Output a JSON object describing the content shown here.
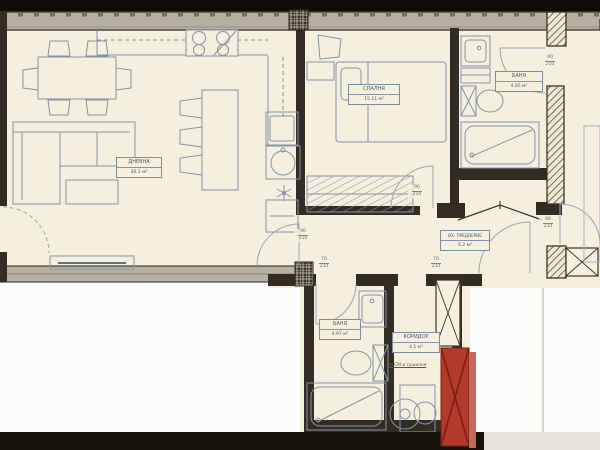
{
  "meta": {
    "type": "architectural-floor-plan",
    "language": "bg"
  },
  "rooms": [
    {
      "id": "living",
      "name": "ДНЕВНА",
      "area": "30.1 м²"
    },
    {
      "id": "bedroom",
      "name": "СПАЛНЯ",
      "area": "15.11 м²"
    },
    {
      "id": "bath_top",
      "name": "БАНЯ",
      "area": "4.85 м²"
    },
    {
      "id": "vestibule",
      "name": "ВХ. ПРЕДВЕРИЕ",
      "area": "6.2 м²"
    },
    {
      "id": "bath_bottom",
      "name": "БАНЯ",
      "area": "4.97 м²"
    },
    {
      "id": "corridor",
      "name": "КОРИДОР",
      "area": "4.1 м²"
    }
  ],
  "door_dimensions": [
    {
      "width": "90",
      "height": "210"
    },
    {
      "width": "90",
      "height": "210"
    },
    {
      "width": "90",
      "height": "210"
    },
    {
      "width": "70",
      "height": "210"
    },
    {
      "width": "70",
      "height": "210"
    },
    {
      "width": "90",
      "height": "210"
    }
  ],
  "notes": {
    "corridor_note": "за СМ и сушилня"
  },
  "colors": {
    "paper": "#f5f0dd",
    "wall_dark": "#332c22",
    "wall_band_gray": "#b6b0a1",
    "furniture_line": "#8595a5",
    "accent_red": "#b23a28",
    "accent_red_dark": "#7c1d12",
    "top_strip": "#0e0b07",
    "bottom_strip": "#17120b"
  }
}
